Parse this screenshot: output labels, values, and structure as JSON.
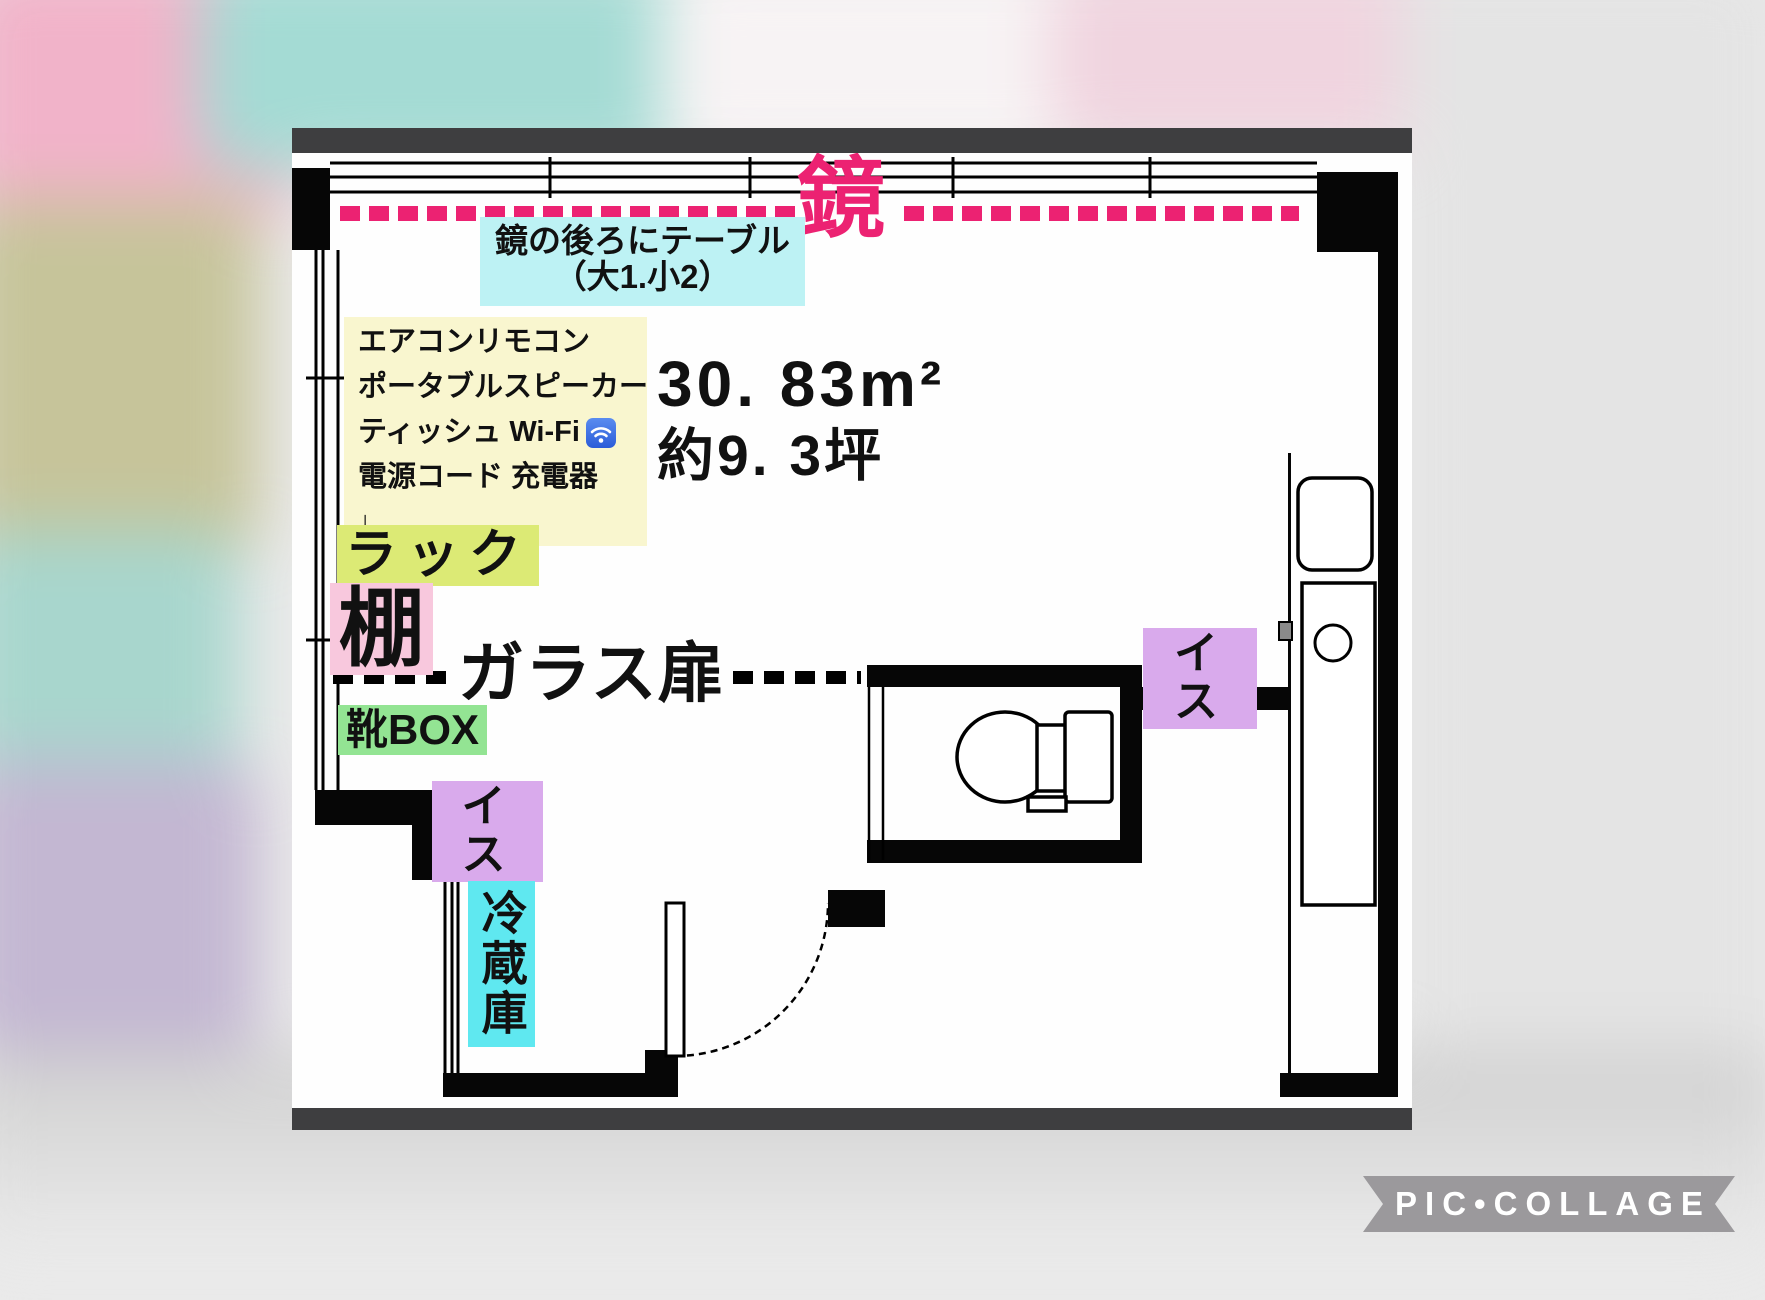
{
  "photo": {
    "frame_color": "#3e3e40",
    "accent_pink": "#ec2272",
    "mirror": {
      "label": "鏡"
    },
    "mirror_note": {
      "line1": "鏡の後ろにテーブル",
      "line2": "（大1.小2）",
      "bg": "#bdf2f4"
    },
    "amenities": {
      "bg": "#f9f6cf",
      "lines": [
        "エアコンリモコン",
        "ポータブルスピーカー",
        "ティッシュ Wi-Fi",
        "電源コード 充電器",
        "↓"
      ]
    },
    "area": {
      "m2": "30. 83m²",
      "tsubo": "約9. 3坪"
    },
    "labels": {
      "rack": {
        "text": "ラック",
        "bg": "#dcea75"
      },
      "shelf": {
        "text": "棚",
        "bg": "#f8c8dd"
      },
      "glass_door": {
        "text": "ガラス扉"
      },
      "shoe_box": {
        "text": "靴BOX",
        "bg": "#93e493"
      },
      "chair_left": {
        "text": "イス",
        "bg": "#d9aaec"
      },
      "chair_right": {
        "text": "イス",
        "bg": "#d9aaec"
      },
      "fridge": {
        "text": "冷蔵庫",
        "bg": "#5fe8f0"
      }
    }
  },
  "watermark": {
    "text": "PIC•COLLAGE",
    "bg": "#9b999c"
  }
}
